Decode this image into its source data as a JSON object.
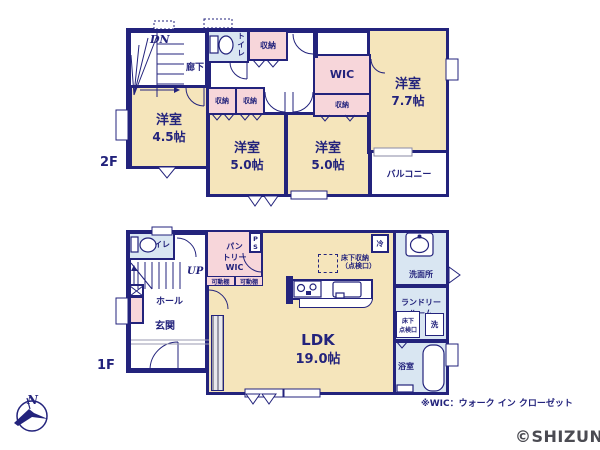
{
  "common": {
    "storage": "収納",
    "toilet": "トイレ",
    "wic": "WIC"
  },
  "floor2": {
    "label": "2F",
    "stairs_down": "DN",
    "hallway": "廊下",
    "rooms": {
      "r45": {
        "name": "洋室",
        "size": "4.5帖"
      },
      "r50a": {
        "name": "洋室",
        "size": "5.0帖"
      },
      "r50b": {
        "name": "洋室",
        "size": "5.0帖"
      },
      "r77": {
        "name": "洋室",
        "size": "7.7帖"
      },
      "balcony": "バルコニー"
    }
  },
  "floor1": {
    "label": "1F",
    "stairs_up": "UP",
    "hall": "ホール",
    "entrance": "玄関",
    "pantry_line1": "パン",
    "pantry_line2": "トリー",
    "ps": "PS",
    "shelf": "可動棚",
    "fridge": "冷",
    "underfloor_storage_line1": "床下収納",
    "underfloor_storage_line2": "（点検口）",
    "ldk": {
      "name": "LDK",
      "size": "19.0帖"
    },
    "washroom": "洗面所",
    "laundry_line1": "ランドリー",
    "laundry_line2": "ルーム",
    "underfloor_inspect_line1": "床下",
    "underfloor_inspect_line2": "点検口",
    "washer": "洗",
    "bathroom": "浴室"
  },
  "footer": {
    "note": "※WIC：ウォーク イン クローゼット",
    "watermark": "©SHIZUNAV",
    "compass_north": "N"
  },
  "colors": {
    "wall": "#23237c",
    "room": "#f5e5bb",
    "closet": "#f7d6da",
    "sanitary": "#d9e6f2"
  }
}
